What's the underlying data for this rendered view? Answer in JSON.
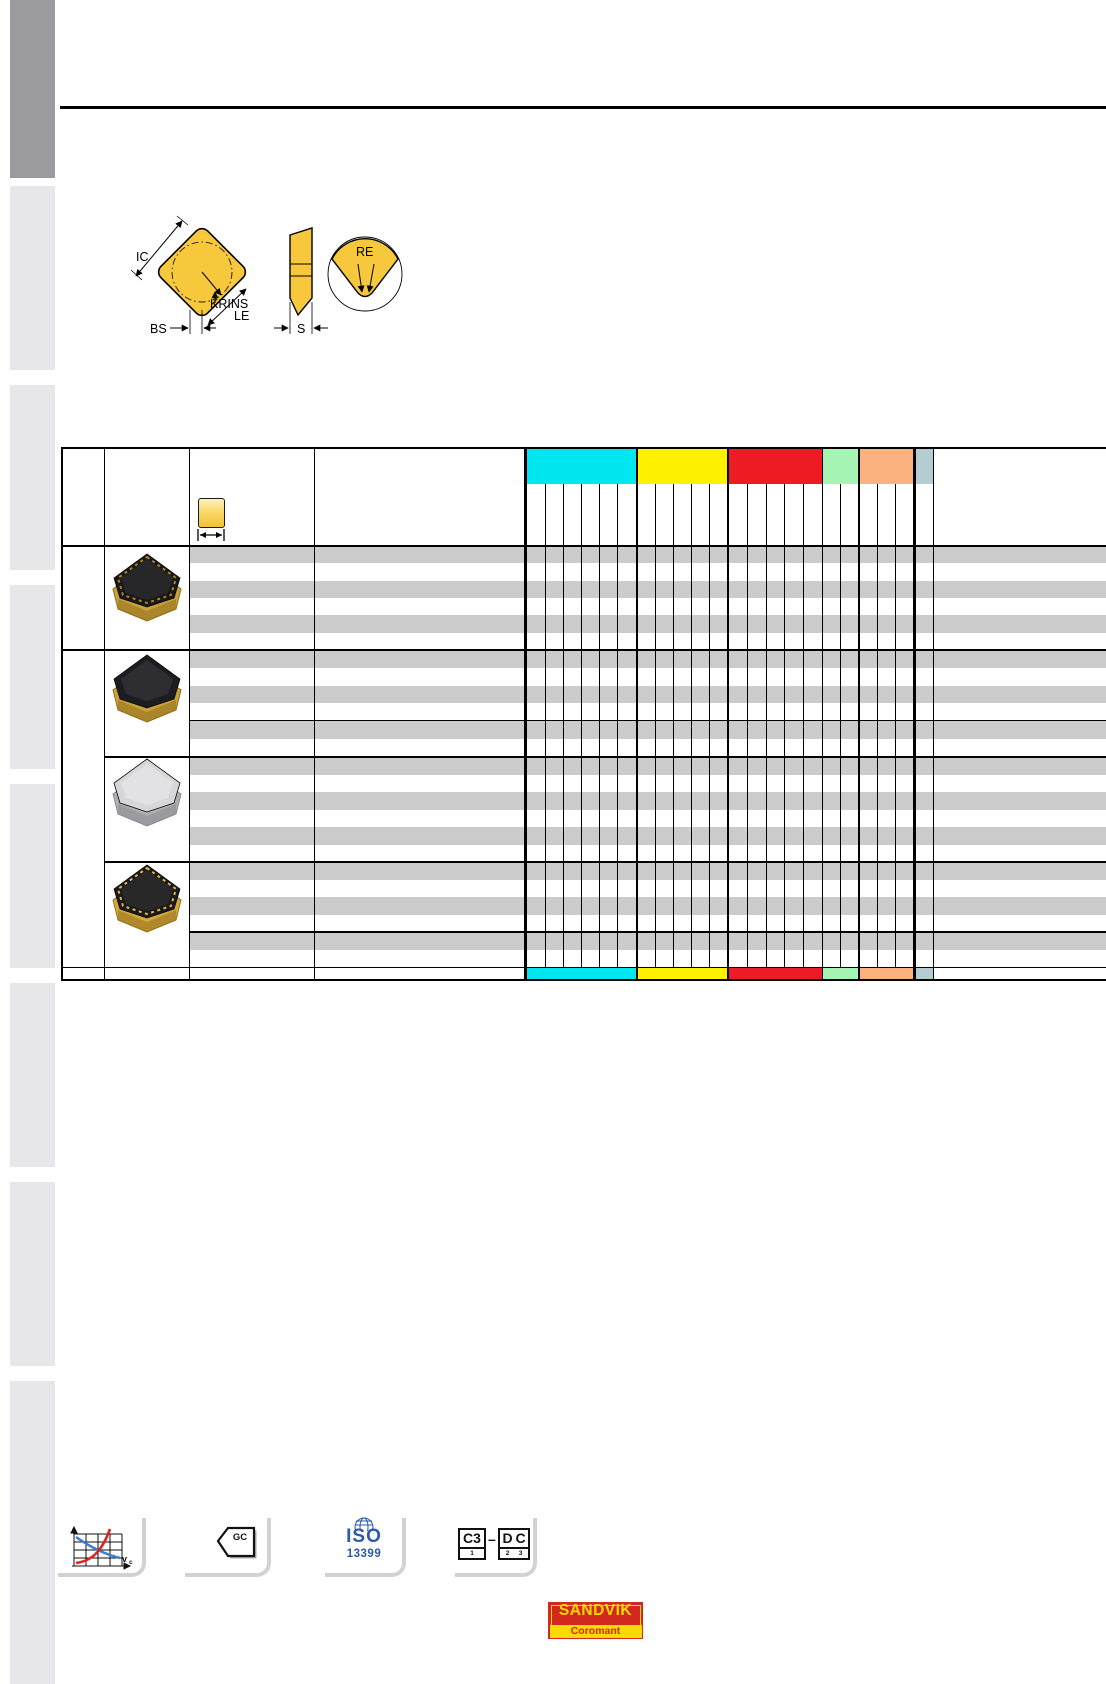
{
  "page_type": "tooling-catalog-insert-dimension-page",
  "diagram": {
    "labels": {
      "ic": "IC",
      "krins": "KRINS",
      "le": "LE",
      "bs": "BS",
      "s": "S",
      "re": "RE"
    },
    "insert_color": "#f7c83b"
  },
  "table": {
    "stripe_color": "#cbcbcb",
    "column_groups": [
      {
        "name": "cyan-band",
        "color": "#00e7ef",
        "columns": 6
      },
      {
        "name": "yellow-band",
        "color": "#fff200",
        "columns": 5
      },
      {
        "name": "red-band",
        "color": "#ed1c24",
        "columns": 5
      },
      {
        "name": "green-band",
        "color": "#a5f4b3",
        "columns": 2
      },
      {
        "name": "orange-band",
        "color": "#fcb27f",
        "columns": 3
      },
      {
        "name": "bluegray-band",
        "color": "#b5cdd2",
        "columns": 1
      }
    ],
    "sections": [
      {
        "insert_style": "black-textured-gold-rim",
        "rows": 6
      },
      {
        "insert_style": "black-smooth-gold-rim",
        "rows": 6,
        "divider_after_row": 4
      },
      {
        "insert_style": "silver-uncoated",
        "rows": 6
      },
      {
        "insert_style": "black-gold-textured",
        "rows": 6,
        "divider_after_row": 4
      }
    ]
  },
  "footer_icons": {
    "graph": {
      "axis_label_main": "v",
      "axis_label_sub": "c",
      "curve_up_color": "#e02222",
      "curve_down_color": "#3a7fd5"
    },
    "gc": {
      "label": "GC"
    },
    "iso": {
      "line1": "ISO",
      "line2": "13399",
      "color": "#2d59a8"
    },
    "code": {
      "box1": "C3",
      "sub1": "1",
      "dash": "–",
      "box2": "D",
      "sub2": "2",
      "box3": "C",
      "sub3": "3"
    }
  },
  "logo": {
    "line1": "SANDVIK",
    "line2": "Coromant",
    "red": "#d3281e",
    "yellow": "#fcd900"
  }
}
